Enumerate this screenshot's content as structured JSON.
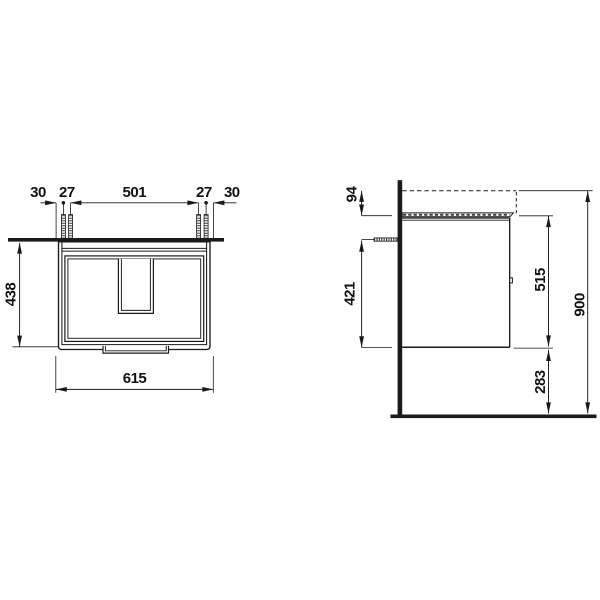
{
  "drawing": {
    "front_view": {
      "top_chain": {
        "offset_left": "30",
        "bolt_gap_left": "27",
        "bolt_span": "501",
        "bolt_gap_right": "27",
        "offset_right": "30"
      },
      "height": "438",
      "width": "615"
    },
    "side_view": {
      "top_offset": "94",
      "bolt_to_bottom": "421",
      "body_height": "515",
      "bottom_clearance": "283",
      "overall_height": "900"
    }
  }
}
